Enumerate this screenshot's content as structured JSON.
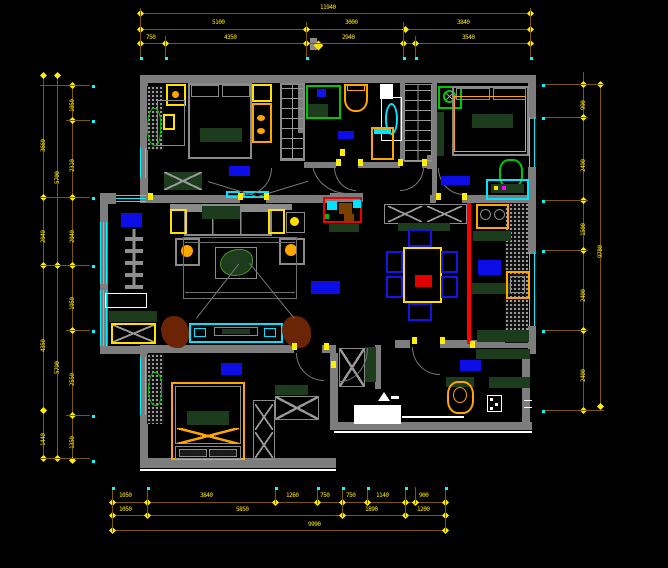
{
  "colors": {
    "background": "#000000",
    "wall": "#7d7d7d",
    "window": "#00F0FF",
    "dimension_line": "#7A5A00",
    "dimension_text": "#FFE800",
    "room_label": "#0D0DE8",
    "accent_red": "#FF0000",
    "furniture_dark_green": "#1d3b1d",
    "furniture_orange": "#FFA500",
    "fixture_green": "#00C800"
  },
  "dimensions": {
    "h_rows": [
      {
        "y": 13,
        "x1": 140,
        "x2": 530,
        "ticks": [
          140,
          530
        ],
        "labels": [
          {
            "t": "11940",
            "x": 320,
            "y": 5
          }
        ]
      },
      {
        "y": 29,
        "x1": 140,
        "x2": 530,
        "ticks": [
          140,
          306,
          405,
          530
        ],
        "labels": [
          {
            "t": "5100",
            "x": 212,
            "y": 20
          },
          {
            "t": "3000",
            "x": 345,
            "y": 20
          },
          {
            "t": "3840",
            "x": 457,
            "y": 20
          }
        ]
      },
      {
        "y": 43,
        "x1": 140,
        "x2": 530,
        "ticks": [
          140,
          165,
          306,
          403,
          415,
          530
        ],
        "labels": [
          {
            "t": "750",
            "x": 146,
            "y": 35
          },
          {
            "t": "4350",
            "x": 224,
            "y": 35
          },
          {
            "t": "2940",
            "x": 342,
            "y": 35
          },
          {
            "t": "3540",
            "x": 462,
            "y": 35
          }
        ]
      },
      {
        "y": 502,
        "x1": 112,
        "x2": 445,
        "ticks": [
          112,
          147,
          275,
          317,
          342,
          367,
          405,
          415,
          445
        ],
        "labels": [
          {
            "t": "1050",
            "x": 119,
            "y": 493
          },
          {
            "t": "3840",
            "x": 200,
            "y": 493
          },
          {
            "t": "1260",
            "x": 286,
            "y": 493
          },
          {
            "t": "750",
            "x": 320,
            "y": 493
          },
          {
            "t": "750",
            "x": 346,
            "y": 493
          },
          {
            "t": "1140",
            "x": 376,
            "y": 493
          },
          {
            "t": "900",
            "x": 419,
            "y": 493
          }
        ]
      },
      {
        "y": 515,
        "x1": 112,
        "x2": 445,
        "ticks": [
          112,
          147,
          342,
          405,
          445
        ],
        "labels": [
          {
            "t": "1050",
            "x": 119,
            "y": 507
          },
          {
            "t": "5850",
            "x": 236,
            "y": 507
          },
          {
            "t": "1890",
            "x": 365,
            "y": 507
          },
          {
            "t": "1200",
            "x": 417,
            "y": 507
          }
        ]
      },
      {
        "y": 530,
        "x1": 112,
        "x2": 445,
        "ticks": [
          112,
          445
        ],
        "labels": [
          {
            "t": "9990",
            "x": 308,
            "y": 522
          }
        ]
      }
    ],
    "v_cols": [
      {
        "x": 43,
        "y1": 75,
        "y2": 458,
        "ticks": [
          75,
          197,
          265,
          410,
          458
        ],
        "labels": [
          {
            "t": "3660",
            "y": 152
          },
          {
            "t": "2040",
            "y": 243
          },
          {
            "t": "4350",
            "y": 352
          },
          {
            "t": "1440",
            "y": 446
          }
        ]
      },
      {
        "x": 57,
        "y1": 75,
        "y2": 458,
        "ticks": [
          75,
          265,
          458
        ],
        "labels": [
          {
            "t": "5700",
            "y": 184
          },
          {
            "t": "5790",
            "y": 374
          }
        ]
      },
      {
        "x": 72,
        "y1": 85,
        "y2": 460,
        "ticks": [
          85,
          120,
          197,
          265,
          330,
          415,
          460
        ],
        "labels": [
          {
            "t": "1050",
            "y": 112
          },
          {
            "t": "2310",
            "y": 172
          },
          {
            "t": "2040",
            "y": 243
          },
          {
            "t": "1950",
            "y": 310
          },
          {
            "t": "2550",
            "y": 386
          },
          {
            "t": "1350",
            "y": 449
          }
        ]
      },
      {
        "x": 583,
        "y1": 72,
        "y2": 410,
        "ticks": [
          84,
          117,
          200,
          250,
          330,
          410
        ],
        "labels": [
          {
            "t": "990",
            "y": 110
          },
          {
            "t": "2490",
            "y": 172
          },
          {
            "t": "1500",
            "y": 236
          },
          {
            "t": "2400",
            "y": 302
          },
          {
            "t": "2400",
            "y": 382
          }
        ]
      },
      {
        "x": 600,
        "y1": 82,
        "y2": 406,
        "ticks": [
          84,
          406
        ],
        "labels": [
          {
            "t": "9780",
            "y": 258
          }
        ]
      }
    ],
    "ext_v": [
      {
        "x": 140,
        "y1": 8,
        "y2": 58
      },
      {
        "x": 165,
        "y1": 36,
        "y2": 58
      },
      {
        "x": 306,
        "y1": 22,
        "y2": 58
      },
      {
        "x": 403,
        "y1": 22,
        "y2": 58
      },
      {
        "x": 415,
        "y1": 36,
        "y2": 58
      },
      {
        "x": 530,
        "y1": 8,
        "y2": 58
      },
      {
        "x": 112,
        "y1": 487,
        "y2": 532
      },
      {
        "x": 147,
        "y1": 487,
        "y2": 517
      },
      {
        "x": 275,
        "y1": 487,
        "y2": 504
      },
      {
        "x": 317,
        "y1": 487,
        "y2": 504
      },
      {
        "x": 342,
        "y1": 487,
        "y2": 517
      },
      {
        "x": 367,
        "y1": 487,
        "y2": 504
      },
      {
        "x": 405,
        "y1": 487,
        "y2": 517
      },
      {
        "x": 415,
        "y1": 487,
        "y2": 504
      },
      {
        "x": 445,
        "y1": 487,
        "y2": 532
      }
    ],
    "ext_h": [
      {
        "y": 85,
        "x1": 40,
        "x2": 90
      },
      {
        "y": 120,
        "x1": 66,
        "x2": 90
      },
      {
        "y": 197,
        "x1": 40,
        "x2": 90
      },
      {
        "y": 265,
        "x1": 40,
        "x2": 90
      },
      {
        "y": 330,
        "x1": 66,
        "x2": 90
      },
      {
        "y": 415,
        "x1": 66,
        "x2": 90
      },
      {
        "y": 458,
        "x1": 40,
        "x2": 90
      },
      {
        "y": 84,
        "x1": 545,
        "x2": 604
      },
      {
        "y": 117,
        "x1": 545,
        "x2": 588
      },
      {
        "y": 200,
        "x1": 545,
        "x2": 588
      },
      {
        "y": 250,
        "x1": 545,
        "x2": 588
      },
      {
        "y": 330,
        "x1": 545,
        "x2": 588
      },
      {
        "y": 410,
        "x1": 545,
        "x2": 604
      }
    ]
  },
  "cyan_dots": [
    [
      140,
      57
    ],
    [
      165,
      57
    ],
    [
      306,
      57
    ],
    [
      403,
      57
    ],
    [
      415,
      57
    ],
    [
      530,
      57
    ],
    [
      112,
      487
    ],
    [
      147,
      487
    ],
    [
      275,
      487
    ],
    [
      317,
      487
    ],
    [
      342,
      487
    ],
    [
      367,
      487
    ],
    [
      405,
      487
    ],
    [
      445,
      487
    ],
    [
      92,
      85
    ],
    [
      92,
      120
    ],
    [
      92,
      197
    ],
    [
      92,
      265
    ],
    [
      92,
      330
    ],
    [
      92,
      415
    ],
    [
      92,
      460
    ],
    [
      542,
      84
    ],
    [
      542,
      117
    ],
    [
      542,
      200
    ],
    [
      542,
      250
    ],
    [
      542,
      330
    ],
    [
      542,
      410
    ]
  ],
  "hinges": [
    [
      238,
      193
    ],
    [
      264,
      193
    ],
    [
      436,
      193
    ],
    [
      462,
      193
    ],
    [
      336,
      159
    ],
    [
      358,
      159
    ],
    [
      398,
      159
    ],
    [
      422,
      159
    ],
    [
      340,
      149
    ],
    [
      292,
      343
    ],
    [
      324,
      343
    ],
    [
      412,
      337
    ],
    [
      440,
      337
    ],
    [
      470,
      341
    ],
    [
      331,
      361
    ],
    [
      148,
      193
    ]
  ],
  "room_labels": [
    {
      "id": "balcony-label",
      "x": 121,
      "y": 213,
      "w": 21,
      "h": 14
    },
    {
      "id": "bedroom1-label",
      "x": 229,
      "y": 166,
      "w": 21,
      "h": 10
    },
    {
      "id": "bathroom-label",
      "x": 338,
      "y": 131,
      "w": 16,
      "h": 8
    },
    {
      "id": "bedroom2-label",
      "x": 441,
      "y": 176,
      "w": 29,
      "h": 9
    },
    {
      "id": "living-room-label",
      "x": 311,
      "y": 281,
      "w": 29,
      "h": 13
    },
    {
      "id": "kitchen-label",
      "x": 478,
      "y": 260,
      "w": 23,
      "h": 15
    },
    {
      "id": "bedroom3-label",
      "x": 221,
      "y": 363,
      "w": 21,
      "h": 12
    },
    {
      "id": "entry-label",
      "x": 460,
      "y": 360,
      "w": 21,
      "h": 11
    }
  ]
}
